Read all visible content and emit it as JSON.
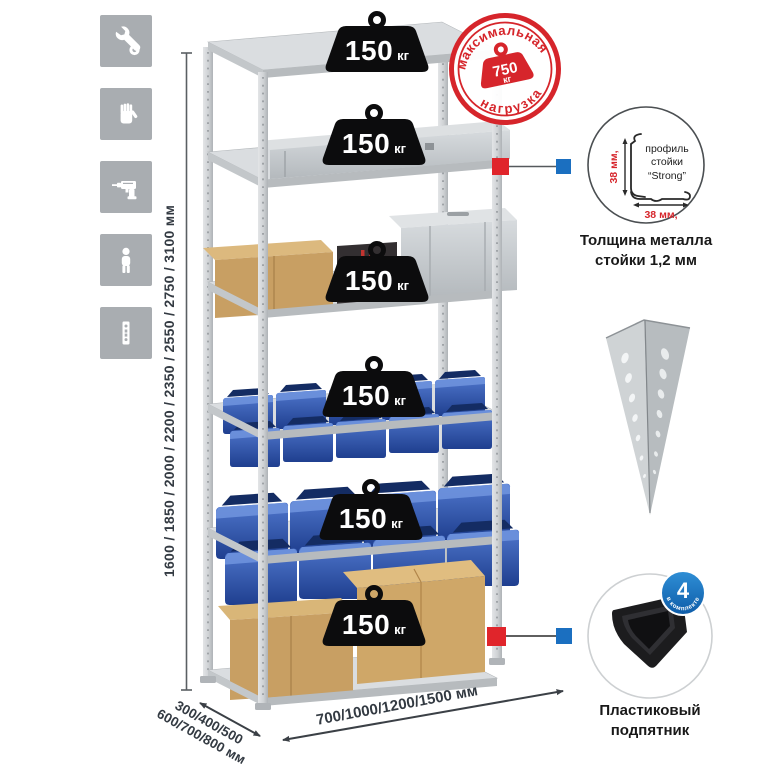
{
  "canvas": {
    "width": 765,
    "height": 765,
    "background": "#ffffff"
  },
  "sidebar": {
    "tile_color": "#a9adb1",
    "icons": [
      {
        "name": "wrench"
      },
      {
        "name": "work-gloves"
      },
      {
        "name": "drill"
      },
      {
        "name": "person"
      },
      {
        "name": "perforated-profile"
      }
    ]
  },
  "weights": [
    {
      "value": "150",
      "unit": "кг"
    },
    {
      "value": "150",
      "unit": "кг"
    },
    {
      "value": "150",
      "unit": "кг"
    },
    {
      "value": "150",
      "unit": "кг"
    },
    {
      "value": "150",
      "unit": "кг"
    },
    {
      "value": "150",
      "unit": "кг"
    }
  ],
  "max_load_stamp": {
    "arc_top": "максимальная",
    "arc_bottom": "нагрузка",
    "value": "750",
    "unit": "кг",
    "color": "#d6252b"
  },
  "dimensions": {
    "height_label": "1600 / 1850 / 2000 / 2200 / 2350 / 2550 / 2750 / 3100 мм",
    "depth_label_line1": "300/400/500",
    "depth_label_line2": "600/700/800 мм",
    "width_label": "700/1000/1200/1500 мм"
  },
  "profile_callout": {
    "label_line1": "профиль",
    "label_line2": "стойки",
    "label_line3": "“Strong”",
    "vertical_dim": "38 мм,",
    "horizontal_dim": "38 мм,",
    "caption_line1": "Толщина металла",
    "caption_line2": "стойки 1,2 мм"
  },
  "foot_callout": {
    "badge_value": "4",
    "badge_arc": "в комплекте",
    "caption_line1": "Пластиковый",
    "caption_line2": "подпятник"
  },
  "colors": {
    "connector_red": "#e0252b",
    "connector_blue": "#1b6fc0",
    "stamp_red": "#d6252b",
    "bin_blue": "#2f55ab",
    "metal_gray": "#d4d7d9"
  }
}
